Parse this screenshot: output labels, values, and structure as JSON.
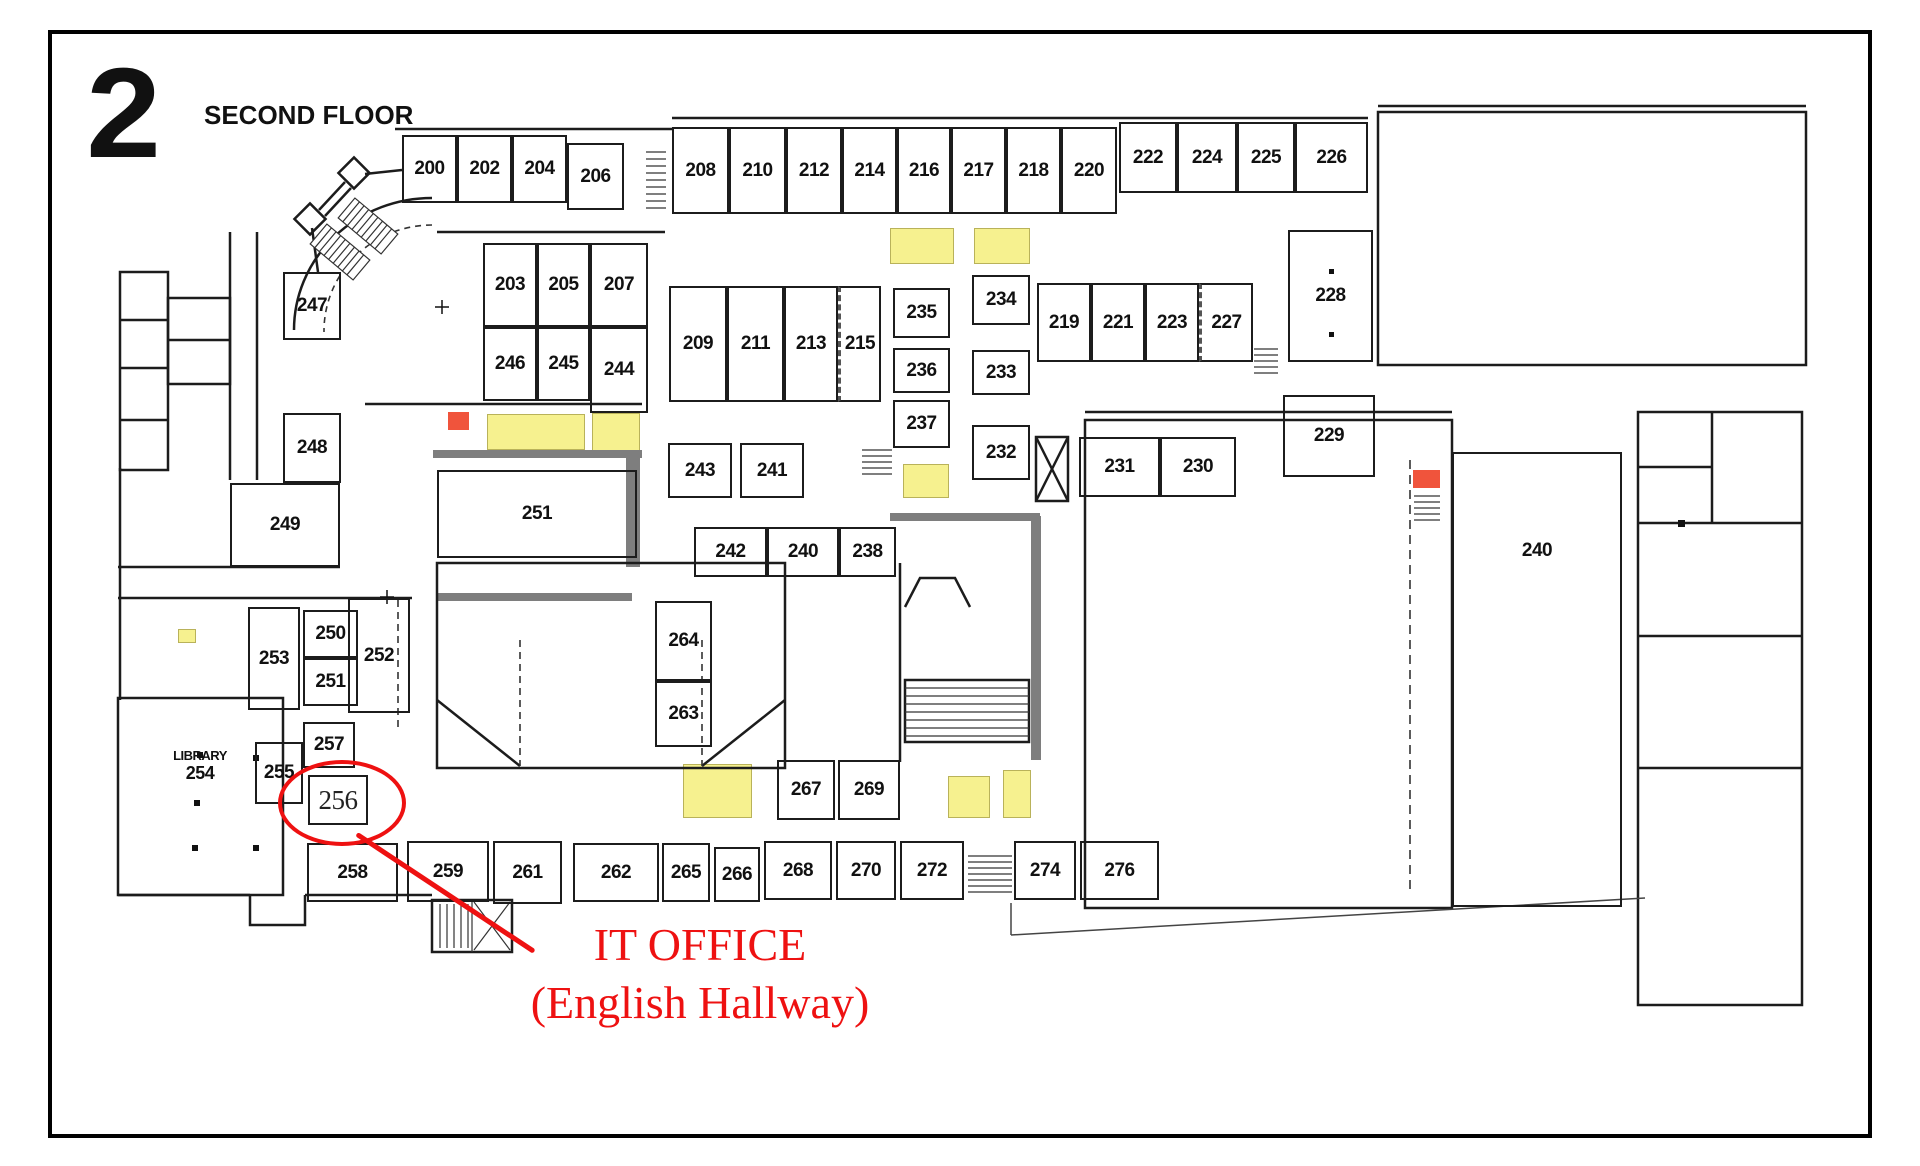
{
  "header": {
    "floor_number": "2",
    "floor_title": "SECOND FLOOR"
  },
  "annotation": {
    "title": "IT OFFICE",
    "subtitle": "(English Hallway)",
    "circled_room": "256"
  },
  "library": {
    "name": "LIBRARY",
    "number": "254"
  },
  "colors": {
    "wall": "#1c1c1c",
    "highlight": "#f6f18f",
    "marker": "#f0543c",
    "annotation": "#ee1111"
  },
  "rooms": [
    {
      "n": "200",
      "x": 402,
      "y": 135,
      "w": 55,
      "h": 68
    },
    {
      "n": "202",
      "x": 457,
      "y": 135,
      "w": 55,
      "h": 68
    },
    {
      "n": "204",
      "x": 512,
      "y": 135,
      "w": 55,
      "h": 68
    },
    {
      "n": "206",
      "x": 567,
      "y": 143,
      "w": 57,
      "h": 67
    },
    {
      "n": "208",
      "x": 672,
      "y": 127,
      "w": 57,
      "h": 87
    },
    {
      "n": "210",
      "x": 729,
      "y": 127,
      "w": 57,
      "h": 87
    },
    {
      "n": "212",
      "x": 786,
      "y": 127,
      "w": 56,
      "h": 87
    },
    {
      "n": "214",
      "x": 842,
      "y": 127,
      "w": 55,
      "h": 87
    },
    {
      "n": "216",
      "x": 897,
      "y": 127,
      "w": 54,
      "h": 87
    },
    {
      "n": "217",
      "x": 951,
      "y": 127,
      "w": 55,
      "h": 87
    },
    {
      "n": "218",
      "x": 1006,
      "y": 127,
      "w": 55,
      "h": 87
    },
    {
      "n": "220",
      "x": 1061,
      "y": 127,
      "w": 56,
      "h": 87
    },
    {
      "n": "222",
      "x": 1119,
      "y": 122,
      "w": 58,
      "h": 71
    },
    {
      "n": "224",
      "x": 1177,
      "y": 122,
      "w": 60,
      "h": 71
    },
    {
      "n": "225",
      "x": 1237,
      "y": 122,
      "w": 58,
      "h": 71
    },
    {
      "n": "226",
      "x": 1295,
      "y": 122,
      "w": 73,
      "h": 71
    },
    {
      "n": "247",
      "x": 283,
      "y": 272,
      "w": 58,
      "h": 68
    },
    {
      "n": "203",
      "x": 483,
      "y": 243,
      "w": 54,
      "h": 84
    },
    {
      "n": "205",
      "x": 537,
      "y": 243,
      "w": 53,
      "h": 84
    },
    {
      "n": "207",
      "x": 590,
      "y": 243,
      "w": 58,
      "h": 84
    },
    {
      "n": "246",
      "x": 483,
      "y": 327,
      "w": 54,
      "h": 74
    },
    {
      "n": "245",
      "x": 537,
      "y": 327,
      "w": 53,
      "h": 74
    },
    {
      "n": "244",
      "x": 590,
      "y": 327,
      "w": 58,
      "h": 86
    },
    {
      "n": "209",
      "x": 669,
      "y": 286,
      "w": 58,
      "h": 116
    },
    {
      "n": "211",
      "x": 727,
      "y": 286,
      "w": 57,
      "h": 116
    },
    {
      "n": "213",
      "x": 784,
      "y": 286,
      "w": 54,
      "h": 116
    },
    {
      "n": "215",
      "x": 838,
      "y": 286,
      "w": 43,
      "h": 116,
      "cls": "dash-l"
    },
    {
      "n": "235",
      "x": 893,
      "y": 288,
      "w": 57,
      "h": 50
    },
    {
      "n": "236",
      "x": 893,
      "y": 348,
      "w": 57,
      "h": 45
    },
    {
      "n": "237",
      "x": 893,
      "y": 400,
      "w": 57,
      "h": 48
    },
    {
      "n": "234",
      "x": 972,
      "y": 275,
      "w": 58,
      "h": 50
    },
    {
      "n": "233",
      "x": 972,
      "y": 350,
      "w": 58,
      "h": 45
    },
    {
      "n": "232",
      "x": 972,
      "y": 425,
      "w": 58,
      "h": 55
    },
    {
      "n": "219",
      "x": 1037,
      "y": 283,
      "w": 54,
      "h": 79
    },
    {
      "n": "221",
      "x": 1091,
      "y": 283,
      "w": 54,
      "h": 79
    },
    {
      "n": "223",
      "x": 1145,
      "y": 283,
      "w": 54,
      "h": 79
    },
    {
      "n": "227",
      "x": 1199,
      "y": 283,
      "w": 54,
      "h": 79,
      "cls": "dash-l"
    },
    {
      "n": "228",
      "x": 1288,
      "y": 230,
      "w": 85,
      "h": 132
    },
    {
      "n": "248",
      "x": 283,
      "y": 413,
      "w": 58,
      "h": 70
    },
    {
      "n": "243",
      "x": 668,
      "y": 443,
      "w": 64,
      "h": 55
    },
    {
      "n": "241",
      "x": 740,
      "y": 443,
      "w": 64,
      "h": 55
    },
    {
      "n": "229",
      "x": 1283,
      "y": 395,
      "w": 92,
      "h": 82
    },
    {
      "n": "231",
      "x": 1079,
      "y": 437,
      "w": 81,
      "h": 60
    },
    {
      "n": "230",
      "x": 1160,
      "y": 437,
      "w": 76,
      "h": 60
    },
    {
      "n": "249",
      "x": 230,
      "y": 483,
      "w": 110,
      "h": 84
    },
    {
      "n": "251",
      "x": 437,
      "y": 470,
      "w": 200,
      "h": 88
    },
    {
      "n": "242",
      "x": 694,
      "y": 527,
      "w": 73,
      "h": 50
    },
    {
      "n": "240",
      "x": 767,
      "y": 527,
      "w": 72,
      "h": 50
    },
    {
      "n": "238",
      "x": 839,
      "y": 527,
      "w": 57,
      "h": 50
    },
    {
      "n": "253",
      "x": 248,
      "y": 607,
      "w": 52,
      "h": 103
    },
    {
      "n": "250",
      "x": 303,
      "y": 610,
      "w": 55,
      "h": 48
    },
    {
      "n": "251",
      "x": 303,
      "y": 658,
      "w": 55,
      "h": 48
    },
    {
      "n": "252",
      "x": 348,
      "y": 598,
      "w": 62,
      "h": 115
    },
    {
      "n": "264",
      "x": 655,
      "y": 601,
      "w": 57,
      "h": 80
    },
    {
      "n": "263",
      "x": 655,
      "y": 681,
      "w": 57,
      "h": 66
    },
    {
      "n": "257",
      "x": 303,
      "y": 722,
      "w": 52,
      "h": 46
    },
    {
      "n": "255",
      "x": 255,
      "y": 742,
      "w": 48,
      "h": 62
    },
    {
      "n": "256",
      "x": 308,
      "y": 775,
      "w": 60,
      "h": 50,
      "cls": "serif"
    },
    {
      "n": "267",
      "x": 777,
      "y": 760,
      "w": 58,
      "h": 60
    },
    {
      "n": "269",
      "x": 838,
      "y": 760,
      "w": 62,
      "h": 60
    },
    {
      "n": "240",
      "x": 1452,
      "y": 452,
      "w": 170,
      "h": 455,
      "cls": "hall"
    },
    {
      "n": "258",
      "x": 307,
      "y": 843,
      "w": 91,
      "h": 59
    },
    {
      "n": "259",
      "x": 407,
      "y": 841,
      "w": 82,
      "h": 61
    },
    {
      "n": "261",
      "x": 493,
      "y": 841,
      "w": 69,
      "h": 63
    },
    {
      "n": "262",
      "x": 573,
      "y": 843,
      "w": 86,
      "h": 59
    },
    {
      "n": "265",
      "x": 662,
      "y": 843,
      "w": 48,
      "h": 59
    },
    {
      "n": "266",
      "x": 714,
      "y": 847,
      "w": 46,
      "h": 55
    },
    {
      "n": "268",
      "x": 764,
      "y": 841,
      "w": 68,
      "h": 59
    },
    {
      "n": "270",
      "x": 836,
      "y": 841,
      "w": 60,
      "h": 59
    },
    {
      "n": "272",
      "x": 900,
      "y": 841,
      "w": 64,
      "h": 59
    },
    {
      "n": "274",
      "x": 1014,
      "y": 841,
      "w": 62,
      "h": 59
    },
    {
      "n": "276",
      "x": 1080,
      "y": 841,
      "w": 79,
      "h": 59
    }
  ],
  "highlights": [
    {
      "x": 890,
      "y": 228,
      "w": 64,
      "h": 36
    },
    {
      "x": 974,
      "y": 228,
      "w": 56,
      "h": 36
    },
    {
      "x": 487,
      "y": 414,
      "w": 98,
      "h": 36
    },
    {
      "x": 592,
      "y": 413,
      "w": 48,
      "h": 38
    },
    {
      "x": 903,
      "y": 464,
      "w": 46,
      "h": 34
    },
    {
      "x": 178,
      "y": 629,
      "w": 18,
      "h": 14
    },
    {
      "x": 683,
      "y": 764,
      "w": 69,
      "h": 54
    },
    {
      "x": 948,
      "y": 776,
      "w": 42,
      "h": 42
    },
    {
      "x": 1003,
      "y": 770,
      "w": 28,
      "h": 48
    }
  ],
  "markers": [
    {
      "x": 448,
      "y": 412,
      "w": 21,
      "h": 18
    },
    {
      "x": 1413,
      "y": 470,
      "w": 27,
      "h": 18
    }
  ]
}
